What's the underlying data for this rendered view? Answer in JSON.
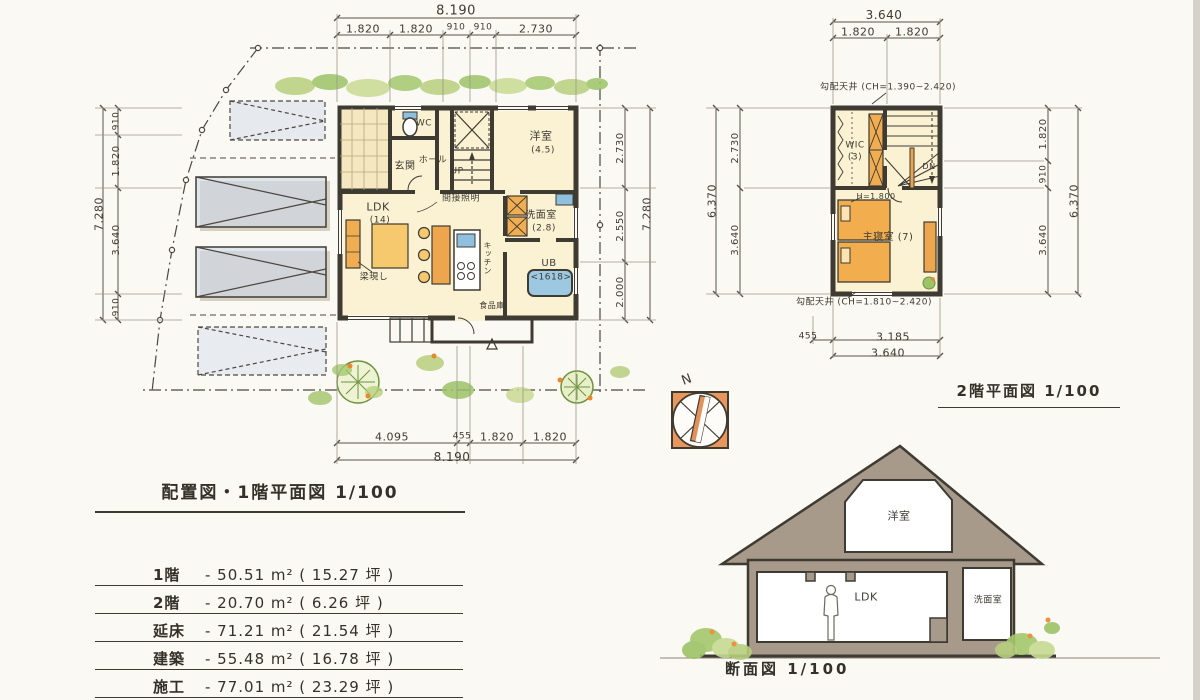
{
  "titles": {
    "floor1": "配置図・1階平面図  1/100",
    "floor2": "2階平面図  1/100",
    "section": "断面図  1/100"
  },
  "area_table": {
    "rows": [
      {
        "label": "1階",
        "value": "- 50.51 m² ( 15.27 坪 )"
      },
      {
        "label": "2階",
        "value": "- 20.70 m² ( 6.26 坪 )"
      },
      {
        "label": "延床",
        "value": "- 71.21 m² ( 21.54 坪 )"
      },
      {
        "label": "建築",
        "value": "- 55.48 m² ( 16.78 坪 )"
      },
      {
        "label": "施工",
        "value": "- 77.01 m² ( 23.29 坪 )"
      }
    ]
  },
  "palette": {
    "paper": "#fbf9f3",
    "ink": "#3e3b33",
    "dim_line": "#55524a",
    "room_fill": "#fbf2d3",
    "furniture_orange": "#f0ad52",
    "furniture_deep": "#eda64d",
    "water_blue": "#8fc0dd",
    "parking_blue": "#cdd8e8",
    "green": "#a4c86e",
    "section_taupe": "#a79a8a",
    "compass_orange": "#e8965c"
  },
  "labels": [
    {
      "name": "f1-dim-top-total",
      "text": "8.190",
      "x": 456,
      "y": 11,
      "size": 13
    },
    {
      "name": "f1-dim-top-seg1",
      "text": "1.820",
      "x": 363,
      "y": 29,
      "size": 11
    },
    {
      "name": "f1-dim-top-seg2",
      "text": "1.820",
      "x": 416,
      "y": 29,
      "size": 11
    },
    {
      "name": "f1-dim-top-seg3",
      "text": "910",
      "x": 456,
      "y": 28,
      "size": 9
    },
    {
      "name": "f1-dim-top-seg4",
      "text": "910",
      "x": 483,
      "y": 28,
      "size": 9
    },
    {
      "name": "f1-dim-top-seg5",
      "text": "2.730",
      "x": 536,
      "y": 29,
      "size": 11
    },
    {
      "name": "f1-dim-left-seg1",
      "text": "910",
      "x": 117,
      "y": 121,
      "rot": -90,
      "size": 9
    },
    {
      "name": "f1-dim-left-seg2",
      "text": "1.820",
      "x": 117,
      "y": 161,
      "rot": -90,
      "size": 10
    },
    {
      "name": "f1-dim-left-seg3",
      "text": "3.640",
      "x": 117,
      "y": 240,
      "rot": -90,
      "size": 10
    },
    {
      "name": "f1-dim-left-seg4",
      "text": "910",
      "x": 117,
      "y": 307,
      "rot": -90,
      "size": 9
    },
    {
      "name": "f1-dim-left-total",
      "text": "7.280",
      "x": 99,
      "y": 214,
      "rot": -90,
      "size": 11
    },
    {
      "name": "f1-dim-right-seg1",
      "text": "2.730",
      "x": 621,
      "y": 148,
      "rot": -90,
      "size": 10
    },
    {
      "name": "f1-dim-right-seg2",
      "text": "2.550",
      "x": 621,
      "y": 226,
      "rot": -90,
      "size": 10
    },
    {
      "name": "f1-dim-right-seg3",
      "text": "2.000",
      "x": 621,
      "y": 292,
      "rot": -90,
      "size": 10
    },
    {
      "name": "f1-dim-right-total",
      "text": "7.280",
      "x": 647,
      "y": 214,
      "rot": -90,
      "size": 11
    },
    {
      "name": "f1-dim-bottom-seg1",
      "text": "4.095",
      "x": 392,
      "y": 437,
      "size": 11
    },
    {
      "name": "f1-dim-bottom-seg2",
      "text": "455",
      "x": 462,
      "y": 437,
      "size": 9
    },
    {
      "name": "f1-dim-bottom-seg3",
      "text": "1.820",
      "x": 497,
      "y": 437,
      "size": 11
    },
    {
      "name": "f1-dim-bottom-seg4",
      "text": "1.820",
      "x": 550,
      "y": 437,
      "size": 11
    },
    {
      "name": "f1-dim-bottom-total",
      "text": "8.190",
      "x": 452,
      "y": 457,
      "size": 12
    },
    {
      "name": "f1-room-wc",
      "text": "WC",
      "x": 424,
      "y": 124,
      "size": 9
    },
    {
      "name": "f1-room-genkan",
      "text": "玄関",
      "x": 405,
      "y": 167,
      "size": 10
    },
    {
      "name": "f1-room-hall",
      "text": "ホール",
      "x": 433,
      "y": 161,
      "size": 9
    },
    {
      "name": "f1-stairs-up",
      "text": "UP",
      "x": 457,
      "y": 172,
      "size": 9
    },
    {
      "name": "f1-room-yoshitsu",
      "text": "洋室",
      "x": 541,
      "y": 136,
      "size": 11
    },
    {
      "name": "f1-room-yoshitsu-size",
      "text": "(4.5)",
      "x": 543,
      "y": 151,
      "size": 9
    },
    {
      "name": "f1-room-ldk",
      "text": "LDK",
      "x": 378,
      "y": 207,
      "size": 11
    },
    {
      "name": "f1-room-ldk-size",
      "text": "(14)",
      "x": 380,
      "y": 221,
      "size": 9
    },
    {
      "name": "f1-note-indirect-light",
      "text": "間接照明",
      "x": 461,
      "y": 199,
      "size": 9
    },
    {
      "name": "f1-note-exposed-beam",
      "text": "梁現し",
      "x": 374,
      "y": 278,
      "size": 9
    },
    {
      "name": "f1-room-kitchen",
      "text": "キッチン",
      "x": 487,
      "y": 258,
      "size": 8,
      "v": 1
    },
    {
      "name": "f1-room-senmen",
      "text": "洗面室",
      "x": 541,
      "y": 216,
      "size": 10
    },
    {
      "name": "f1-room-senmen-size",
      "text": "(2.8)",
      "x": 544,
      "y": 229,
      "size": 9
    },
    {
      "name": "f1-room-ub",
      "text": "UB",
      "x": 549,
      "y": 264,
      "size": 10
    },
    {
      "name": "f1-room-ub-size",
      "text": "<1618>",
      "x": 551,
      "y": 278,
      "size": 9
    },
    {
      "name": "f1-room-pantry",
      "text": "食品庫",
      "x": 492,
      "y": 306,
      "size": 8
    },
    {
      "name": "f2-dim-top-total",
      "text": "3.640",
      "x": 884,
      "y": 15,
      "size": 12
    },
    {
      "name": "f2-dim-top-seg1",
      "text": "1.820",
      "x": 858,
      "y": 32,
      "size": 11
    },
    {
      "name": "f2-dim-top-seg2",
      "text": "1.820",
      "x": 912,
      "y": 32,
      "size": 11
    },
    {
      "name": "f2-dim-left-seg1",
      "text": "2.730",
      "x": 736,
      "y": 148,
      "rot": -90,
      "size": 10
    },
    {
      "name": "f2-dim-left-seg2",
      "text": "3.640",
      "x": 736,
      "y": 240,
      "rot": -90,
      "size": 10
    },
    {
      "name": "f2-dim-left-total",
      "text": "6.370",
      "x": 712,
      "y": 201,
      "rot": -90,
      "size": 11
    },
    {
      "name": "f2-dim-right-seg1",
      "text": "1.820",
      "x": 1044,
      "y": 134,
      "rot": -90,
      "size": 10
    },
    {
      "name": "f2-dim-right-seg2",
      "text": "910",
      "x": 1044,
      "y": 174,
      "rot": -90,
      "size": 9
    },
    {
      "name": "f2-dim-right-seg3",
      "text": "3.640",
      "x": 1044,
      "y": 240,
      "rot": -90,
      "size": 10
    },
    {
      "name": "f2-dim-right-total",
      "text": "6.370",
      "x": 1074,
      "y": 201,
      "rot": -90,
      "size": 11
    },
    {
      "name": "f2-dim-bottom-seg1",
      "text": "455",
      "x": 808,
      "y": 337,
      "size": 9
    },
    {
      "name": "f2-dim-bottom-seg2",
      "text": "3.185",
      "x": 893,
      "y": 337,
      "size": 11
    },
    {
      "name": "f2-dim-bottom-total",
      "text": "3.640",
      "x": 888,
      "y": 353,
      "size": 11
    },
    {
      "name": "f2-note-sloped-ceiling-top",
      "text": "勾配天井 (CH=1.390~2.420)",
      "x": 888,
      "y": 88,
      "size": 9
    },
    {
      "name": "f2-note-sloped-ceiling-bottom",
      "text": "勾配天井 (CH=1.810~2.420)",
      "x": 864,
      "y": 303,
      "size": 9
    },
    {
      "name": "f2-room-wic",
      "text": "WIC",
      "x": 855,
      "y": 146,
      "size": 9
    },
    {
      "name": "f2-room-wic-size",
      "text": "(3)",
      "x": 855,
      "y": 158,
      "size": 9
    },
    {
      "name": "f2-stairs-dn",
      "text": "DN",
      "x": 929,
      "y": 167,
      "size": 8
    },
    {
      "name": "f2-note-height",
      "text": "H=1.800",
      "x": 876,
      "y": 197,
      "size": 8
    },
    {
      "name": "f2-room-shushinshitsu",
      "text": "主寝室 (7)",
      "x": 888,
      "y": 238,
      "size": 10
    },
    {
      "name": "sec-room-yoshitsu",
      "text": "洋室",
      "x": 899,
      "y": 516,
      "size": 11
    },
    {
      "name": "sec-room-ldk",
      "text": "LDK",
      "x": 866,
      "y": 597,
      "size": 11
    },
    {
      "name": "sec-room-senmen",
      "text": "洗面室",
      "x": 988,
      "y": 601,
      "size": 9
    },
    {
      "name": "compass-north-label",
      "text": "N",
      "x": 687,
      "y": 380,
      "rot": -20,
      "size": 13
    }
  ]
}
